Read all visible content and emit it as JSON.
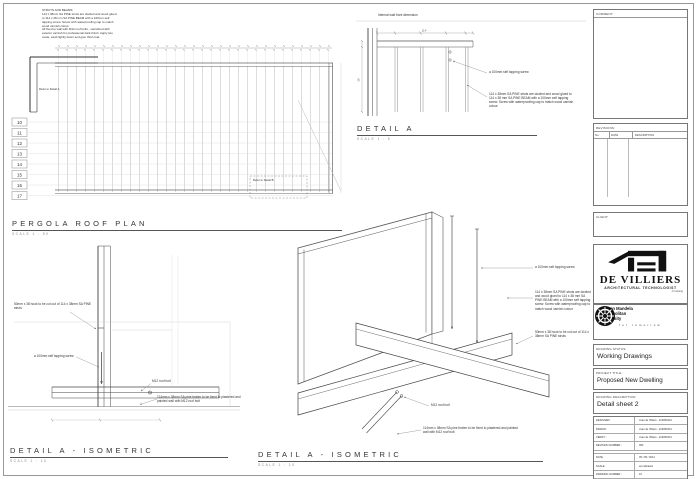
{
  "page": {
    "background": "#ffffff",
    "line_color": "#555555",
    "ink": "#111111"
  },
  "notes": {
    "struts_and_beams": "STRUTS AND BEAMS:\n114 x 38mm SA PINE struts are dowled and wood glued to 114 x 38 mm SA PINE BEAM with a 100mm self tapping screw. Screw with waterproofing cap to match wood varnish colour.\nAll fixed to wall with M12 roof bolts - varnished with exterior varnish for professional dark finish. Apply two coats, sand lightly down and give third coat."
  },
  "plan": {
    "title": "PERGOLA ROOF PLAN",
    "scale": "SCALE 1 : 50",
    "grid_labels": [
      "10",
      "11",
      "12",
      "13",
      "14",
      "15",
      "16",
      "17"
    ],
    "refer_detail_a": "Refer to Detail A",
    "refer_detail_b": "Refer to Detail B"
  },
  "detail_a": {
    "title": "DETAIL A",
    "scale": "SCALE 1 : 5",
    "wall_label": "Internal wall front dimension",
    "ann_screw": "a 100mm self tapping screw",
    "ann_note": "114 x 38mm SA PINE struts are dowled and wood glued to 114 x 38 mm SA PINE BEAM with a 100mm self tapping screw. Screw with waterproofing cap to match wood varnish colour",
    "dims": [
      "114",
      "38"
    ]
  },
  "iso_left": {
    "title": "DETAIL A - ISOMETRIC",
    "scale": "SCALE 1 : 10",
    "ann_hook": "50mm x 38 hook to be cut out of 114 x 38mm SA PINE struts",
    "ann_screw": "a 100mm self tapping screw",
    "ann_bolt": "M12 roof bolt",
    "ann_timber": "114mm x 38mm SA pine timber to be fixed to plastered and painted wall with M12 roof bolt"
  },
  "iso_mid": {
    "title": "DETAIL A - ISOMETRIC",
    "scale": "SCALE 1 : 10",
    "ann_screw": "a 100mm self tapping screw",
    "ann_note": "114 x 38mm SA PINE struts are dowled and wood glued to 114 x 38 mm SA PINE BEAM with a 100mm self tapping screw. Screw with waterproofing cap to match wood varnish colour",
    "ann_hook": "50mm x 38 hook to be cut out of 114 x 38mm SA PINE struts",
    "ann_bolt": "M12 roof bolt",
    "ann_timber": "114mm x 38mm SA pine timber to be fixed to plastered and painted wall with M12 roof bolt"
  },
  "titleblock": {
    "comment_label": "COMMENT:",
    "revisions_label": "REVISIONS:",
    "rev_cols": [
      "No.",
      "DATE",
      "DESCRIPTION"
    ],
    "client_label": "CLIENT:",
    "logo": {
      "name": "DE VILLIERS",
      "subtitle": "ARCHITECTURAL TECHNOLOGIST",
      "tagline": "in training"
    },
    "university": {
      "line1": "Nelson Mandela",
      "line2": "Metropolitan",
      "line3": "University",
      "tagline": "for tomorrow"
    },
    "drawing_status_label": "DRAWING STATUS:",
    "drawing_status": "Working Drawings",
    "project_title_label": "PROJECT TITLE:",
    "project_title": "Proposed New Dwelling",
    "drawing_description_label": "DRAWING DESCRIPTION:",
    "drawing_description": "Detail sheet 2",
    "fields": [
      {
        "label": "DESIGNED :",
        "value": "Juan de Villiers - 213053413"
      },
      {
        "label": "DRAWN :",
        "value": "Juan de Villiers - 213053413"
      },
      {
        "label": "VERIFY :",
        "value": "Juan de Villiers - 213053413"
      },
      {
        "label": "REVISION NUMBER :",
        "value": "000"
      },
      {
        "label": "DATE :",
        "value": "05 / 05 / 2014"
      },
      {
        "label": "SCALE :",
        "value": "as indicated"
      },
      {
        "label": "DRAWING NUMBER :",
        "value": "10"
      },
      {
        "label": "PROJECT NUMBER :",
        "value": "002"
      }
    ]
  }
}
